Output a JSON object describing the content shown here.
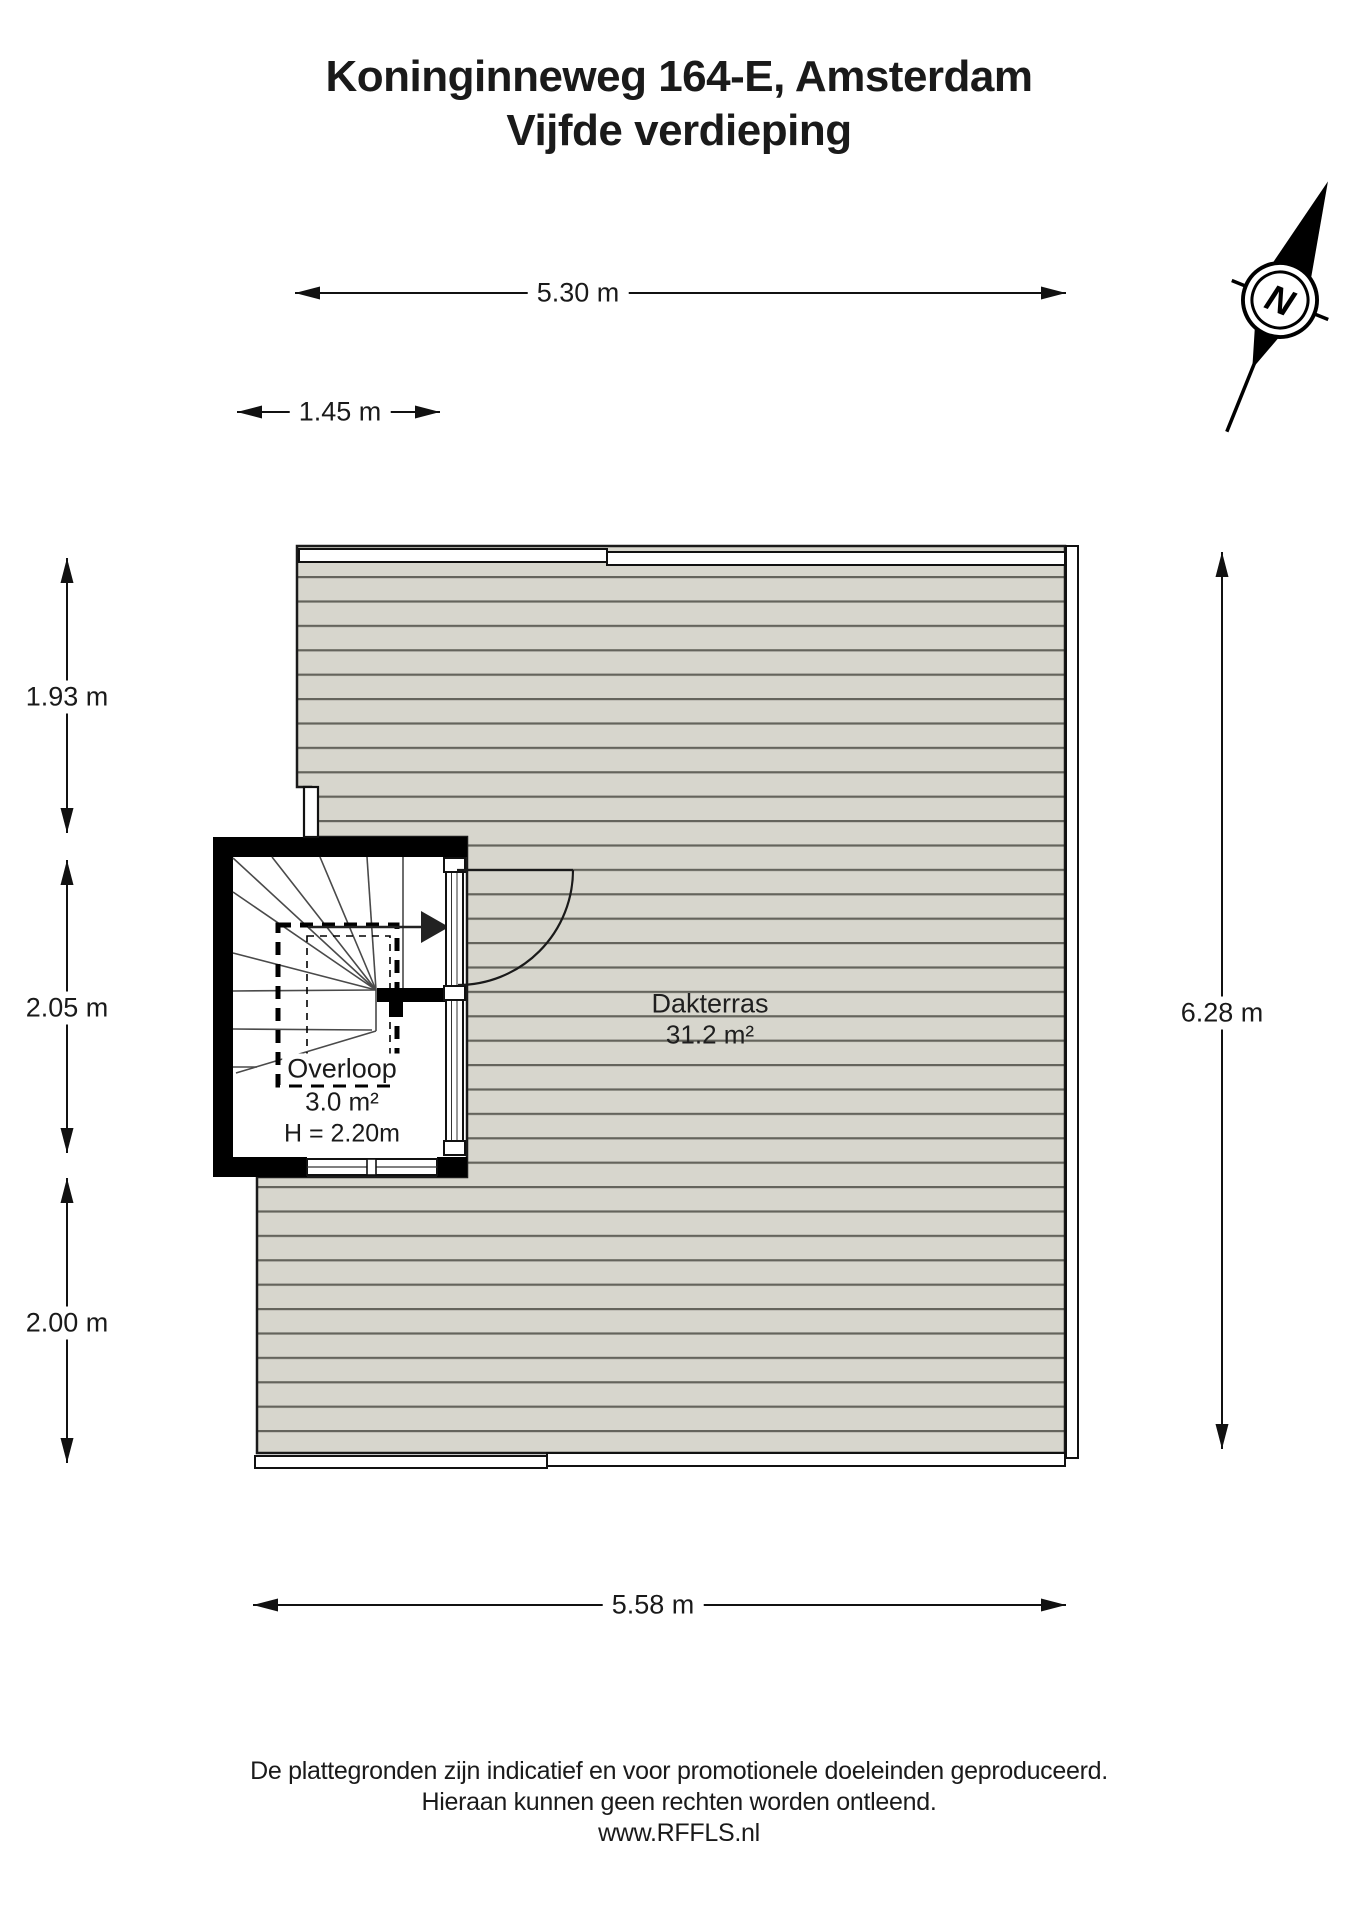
{
  "header": {
    "address": "Koninginneweg 164-E, Amsterdam",
    "floor": "Vijfde verdieping"
  },
  "compass": {
    "north_label": "N"
  },
  "dimensions": {
    "top_width": "5.30 m",
    "stairwell_width": "1.45 m",
    "left_upper": "1.93 m",
    "left_middle": "2.05 m",
    "left_lower": "2.00 m",
    "right_height": "6.28 m",
    "bottom_width": "5.58 m"
  },
  "rooms": {
    "dakterras": {
      "name": "Dakterras",
      "area": "31.2 m²"
    },
    "overloop": {
      "name": "Overloop",
      "area": "3.0 m²",
      "ceiling_height": "H = 2.20m"
    }
  },
  "footer": {
    "line1": "De plattegronden zijn indicatief en voor promotionele doeleinden geproduceerd.",
    "line2": "Hieraan kunnen geen rechten worden ontleend.",
    "line3": "www.RFFLS.nl"
  },
  "colors": {
    "terrace_fill": "#d7d6cd",
    "deck_line": "#64645c",
    "wall": "#000000",
    "text": "#1a1a1a"
  }
}
